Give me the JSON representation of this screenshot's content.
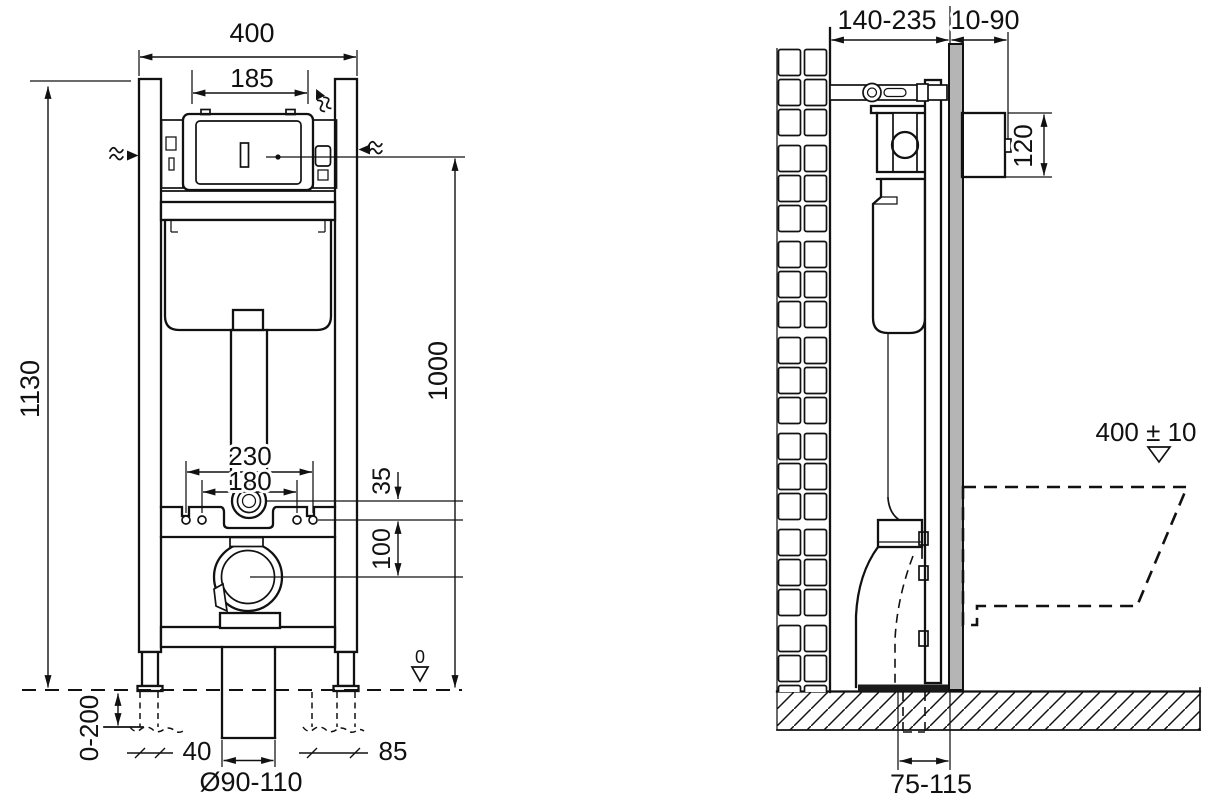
{
  "drawing": {
    "views": {
      "front": {
        "dims": {
          "frame_width": "400",
          "access_opening_width": "185",
          "frame_height": "1130",
          "panel_axis_height": "1000",
          "fixing_spacing_outer": "230",
          "fixing_spacing_inner": "180",
          "inlet_drop": "35",
          "inlet_to_outlet": "100",
          "foot_adjustment_range": "0-200",
          "left_clearance": "40",
          "right_clearance": "85",
          "outlet_pipe_diameter": "Ø90-110",
          "floor_datum": "0"
        }
      },
      "side": {
        "dims": {
          "frame_depth_range": "140-235",
          "wall_finish_range": "10-90",
          "access_box_height": "120",
          "bowl_rim_height": "400 ± 10",
          "outlet_axis_to_wall": "75-115"
        }
      }
    },
    "symbols": {
      "water_supply": "wavy-arrow",
      "floor_datum_marker": "open-triangle-down"
    },
    "colors": {
      "line": "#111111",
      "wall_finish_fill": "#b5b5b5",
      "background": "#ffffff"
    }
  }
}
